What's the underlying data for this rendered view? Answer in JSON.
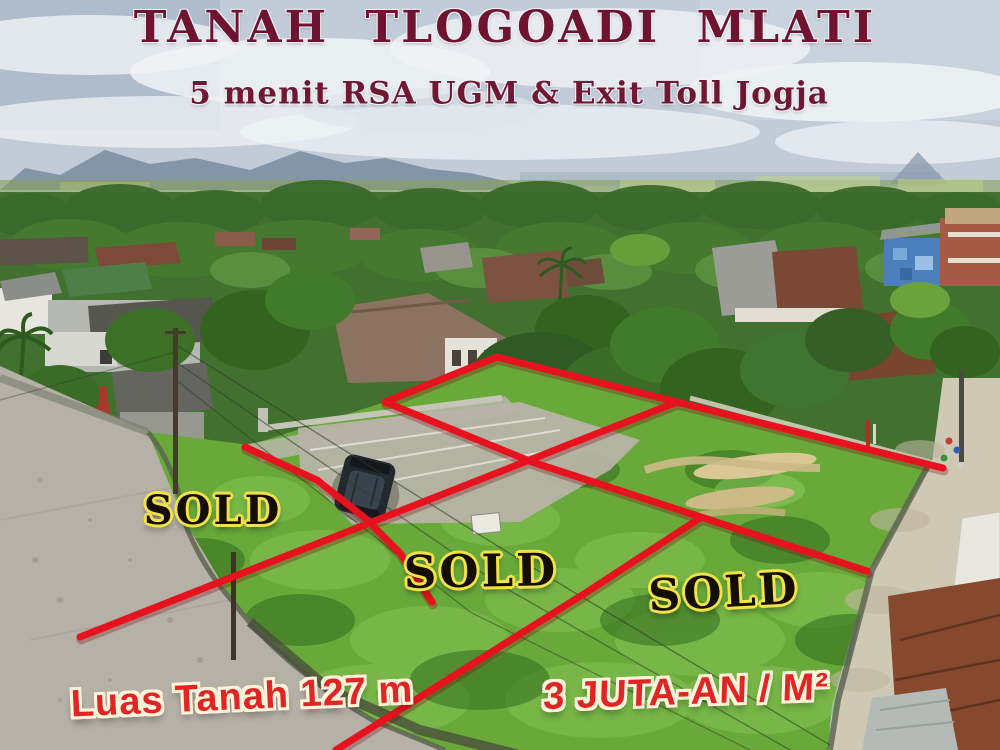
{
  "ad": {
    "title": "TANAH  TLOGOADI  MLATI",
    "subtitle": "5 menit RSA UGM & Exit Toll Jogja",
    "area_label": "Luas Tanah 127 m",
    "price_label": "3 JUTA-AN / M²",
    "sold_labels": [
      "SOLD",
      "SOLD",
      "SOLD"
    ]
  },
  "colors": {
    "title_maroon": "#6e1430",
    "plot_line_red": "#e8111e",
    "sold_text_black": "#140d02",
    "sold_outline_yellow": "#f2e24a",
    "price_text_red": "#e12424",
    "price_outline_cream": "#fcf3da",
    "grass_green": "#69a93a",
    "sky_gray_blue": "#c2ccd8"
  }
}
